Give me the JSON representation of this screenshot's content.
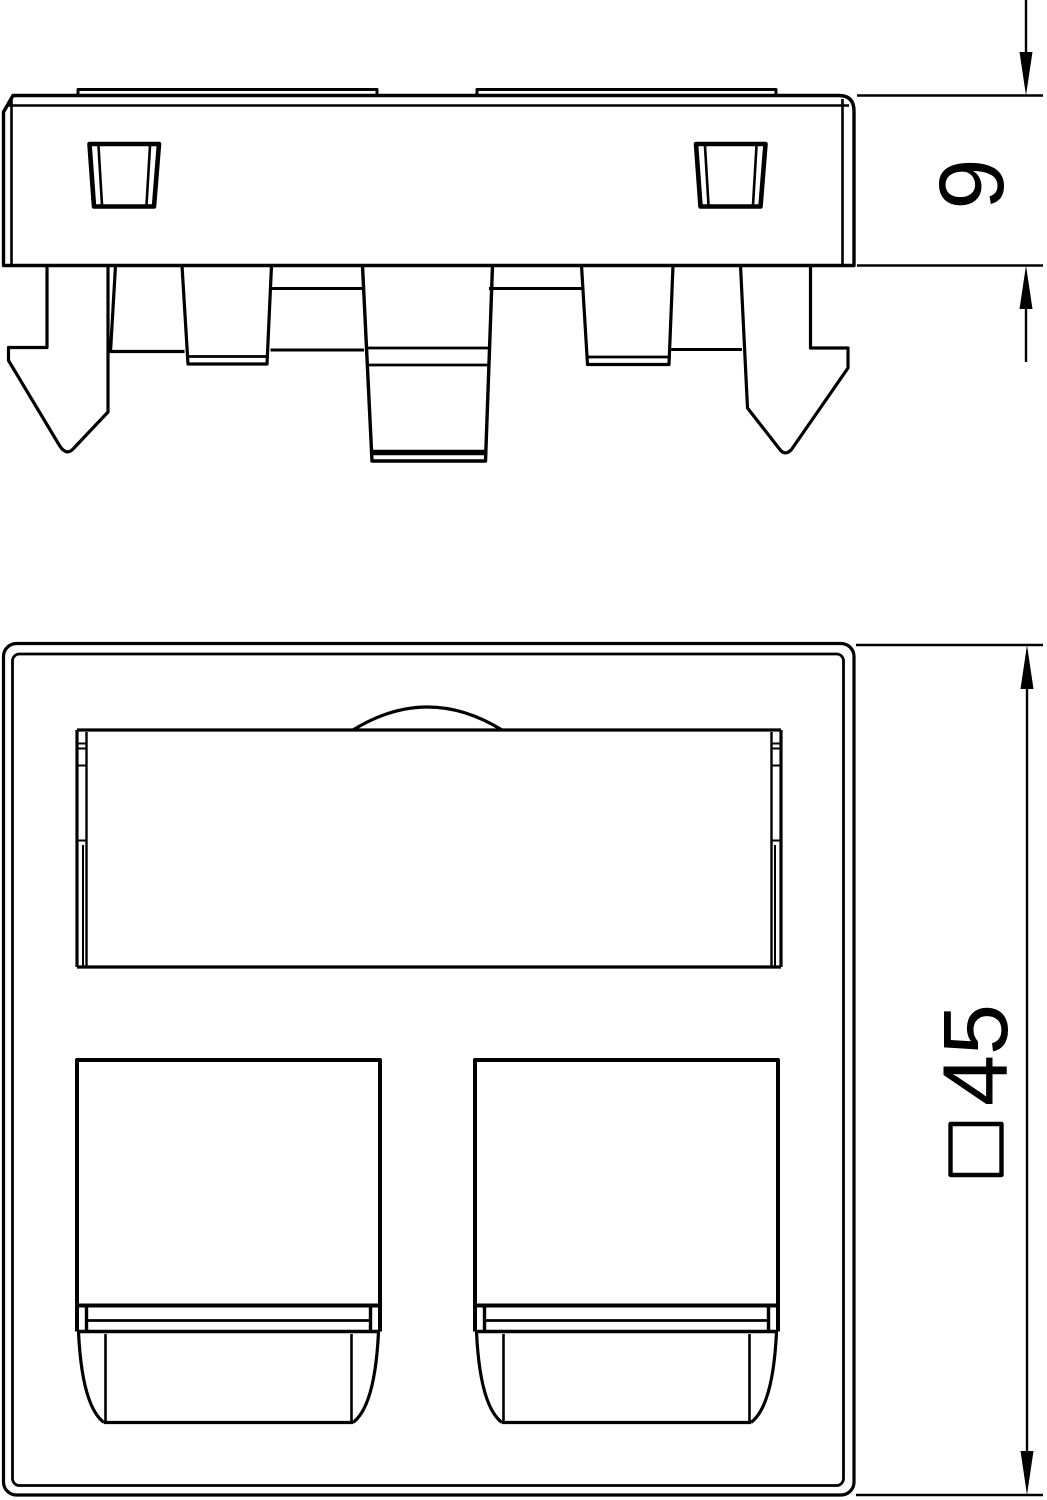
{
  "drawing": {
    "background": "#ffffff",
    "line_color": "#000000"
  },
  "dimensions": {
    "side_height": "9",
    "front_size": "45",
    "front_size_symbol": "□"
  }
}
